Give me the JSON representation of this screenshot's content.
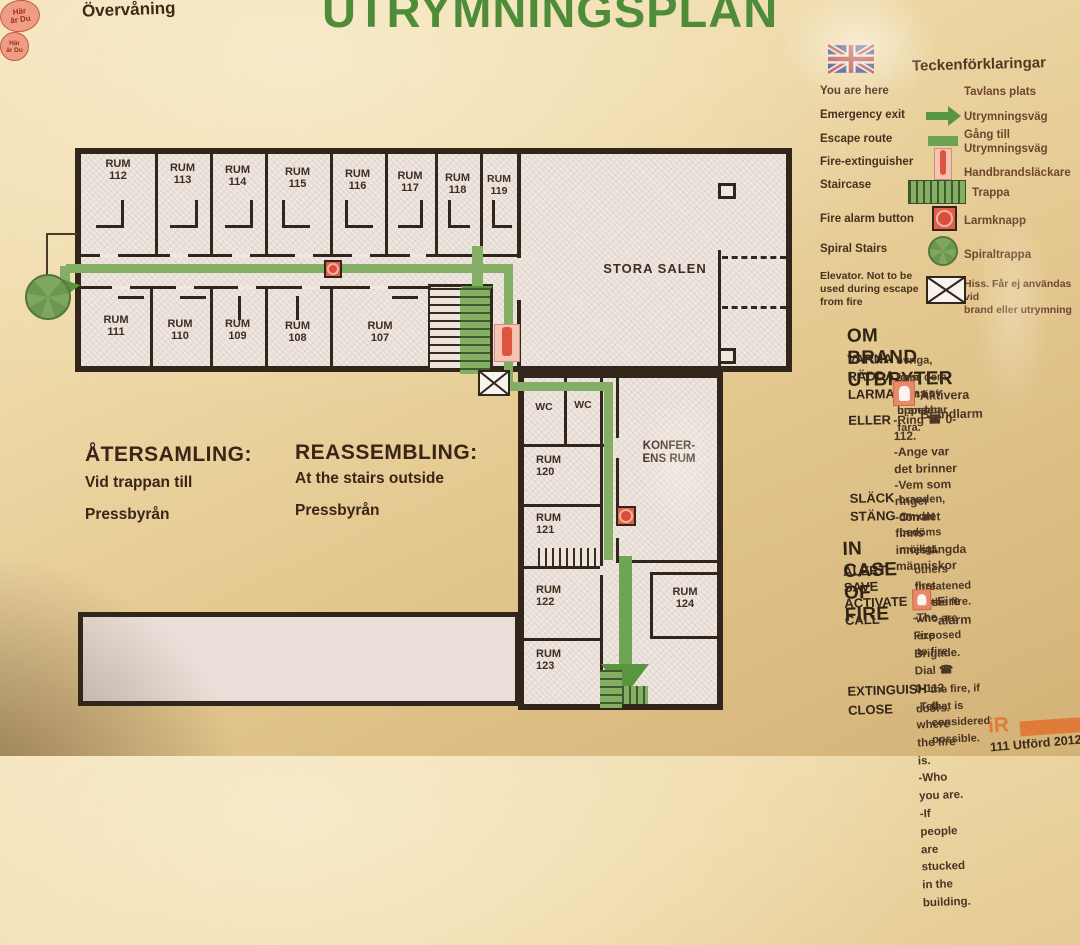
{
  "header": {
    "floor_label": "Övervåning",
    "title": "UTRYMNINGSPLAN"
  },
  "legend": {
    "title": "Teckenförklaringar",
    "marker_text": "Här\när Du",
    "items": [
      {
        "en": "You are here",
        "sv": "Tavlans plats"
      },
      {
        "en": "Emergency exit",
        "sv": "Utrymningsväg"
      },
      {
        "en": "Escape route",
        "sv": "Gång till\nUtrymningsväg"
      },
      {
        "en": "Fire-extinguisher",
        "sv": "Handbrandsläckare"
      },
      {
        "en": "Staircase",
        "sv": "Trappa"
      },
      {
        "en": "Fire alarm button",
        "sv": "Larmknapp"
      },
      {
        "en": "Spiral Stairs",
        "sv": "Spiraltrappa"
      },
      {
        "en": "Elevator. Not to be\nused during escape\nfrom fire",
        "sv": "Hiss. Får ej användas vid\nbrand eller utrymning"
      }
    ]
  },
  "om_brand": {
    "title": "OM BRAND UTBRYTER",
    "varna_term": "VARNA",
    "varna": "övriga, som hotas av branden.",
    "radda_term": "RÄDDA",
    "radda": "först dem som är i uppenbar fara.",
    "larma_term": "LARMA",
    "larma": "Aktivera Brandlarm",
    "eller_term": "ELLER",
    "eller": "-Ring ☎ 0-112.\n-Ange var det brinner\n-Vem som ringer\n-Om det finns innestängda\n människor",
    "slack_term": "SLÄCK",
    "slack": "branden, om det bedöms möjligt.",
    "stang_term": "STÄNG",
    "stang": "dörrar."
  },
  "in_case": {
    "title": "IN CASE OF FIRE",
    "alert_term": "ALERT",
    "alert": "others threatened by the fire.",
    "save_term": "SAVE",
    "save": "first those who are exposed to fire.",
    "activate_term": "ACTIVATE",
    "activate": "Fire alarm",
    "call_term": "CALL",
    "call": "-The Fire Brigade. Dial ☎ 0-112.\n-Tell where the fire is.\n-Who you are.\n-If people are stucked in the building.",
    "extinguish_term": "EXTINGUISH",
    "extinguish": "the fire, if that is considered possible.",
    "close_term": "CLOSE",
    "close": "doors."
  },
  "assembly": {
    "sv_title": "ÅTERSAMLING:",
    "sv_line1": "Vid trappan till",
    "sv_line2": "Pressbyrån",
    "en_title": "REASSEMBLING:",
    "en_line1": "At the stairs outside",
    "en_line2": "Pressbyrån"
  },
  "floorplan": {
    "rooms_top": [
      "RUM\n112",
      "RUM\n113",
      "RUM\n114",
      "RUM\n115",
      "RUM\n116",
      "RUM\n117",
      "RUM\n118",
      "RUM\n119"
    ],
    "rooms_bottom": [
      "RUM\n111",
      "RUM\n110",
      "RUM\n109",
      "RUM\n108",
      "RUM\n107"
    ],
    "wc": [
      "WC",
      "WC"
    ],
    "rooms_lower": [
      "RUM\n120",
      "RUM\n121",
      "RUM\n122",
      "RUM\n123"
    ],
    "room_124": "RUM\n124",
    "stora_salen": "STORA SALEN",
    "konferens": "KONFER-\nENS RUM",
    "you_are_here": "Här\när Du"
  },
  "footer": {
    "logo": "iR",
    "note": "111 Utförd 2012-0"
  },
  "colors": {
    "title_green": "#4e8c3a",
    "route_green": "#84ad66",
    "arrow_green": "#57953f",
    "wall": "#32261a",
    "alarm_red": "#e2604a",
    "paper": "#efe7e1"
  }
}
